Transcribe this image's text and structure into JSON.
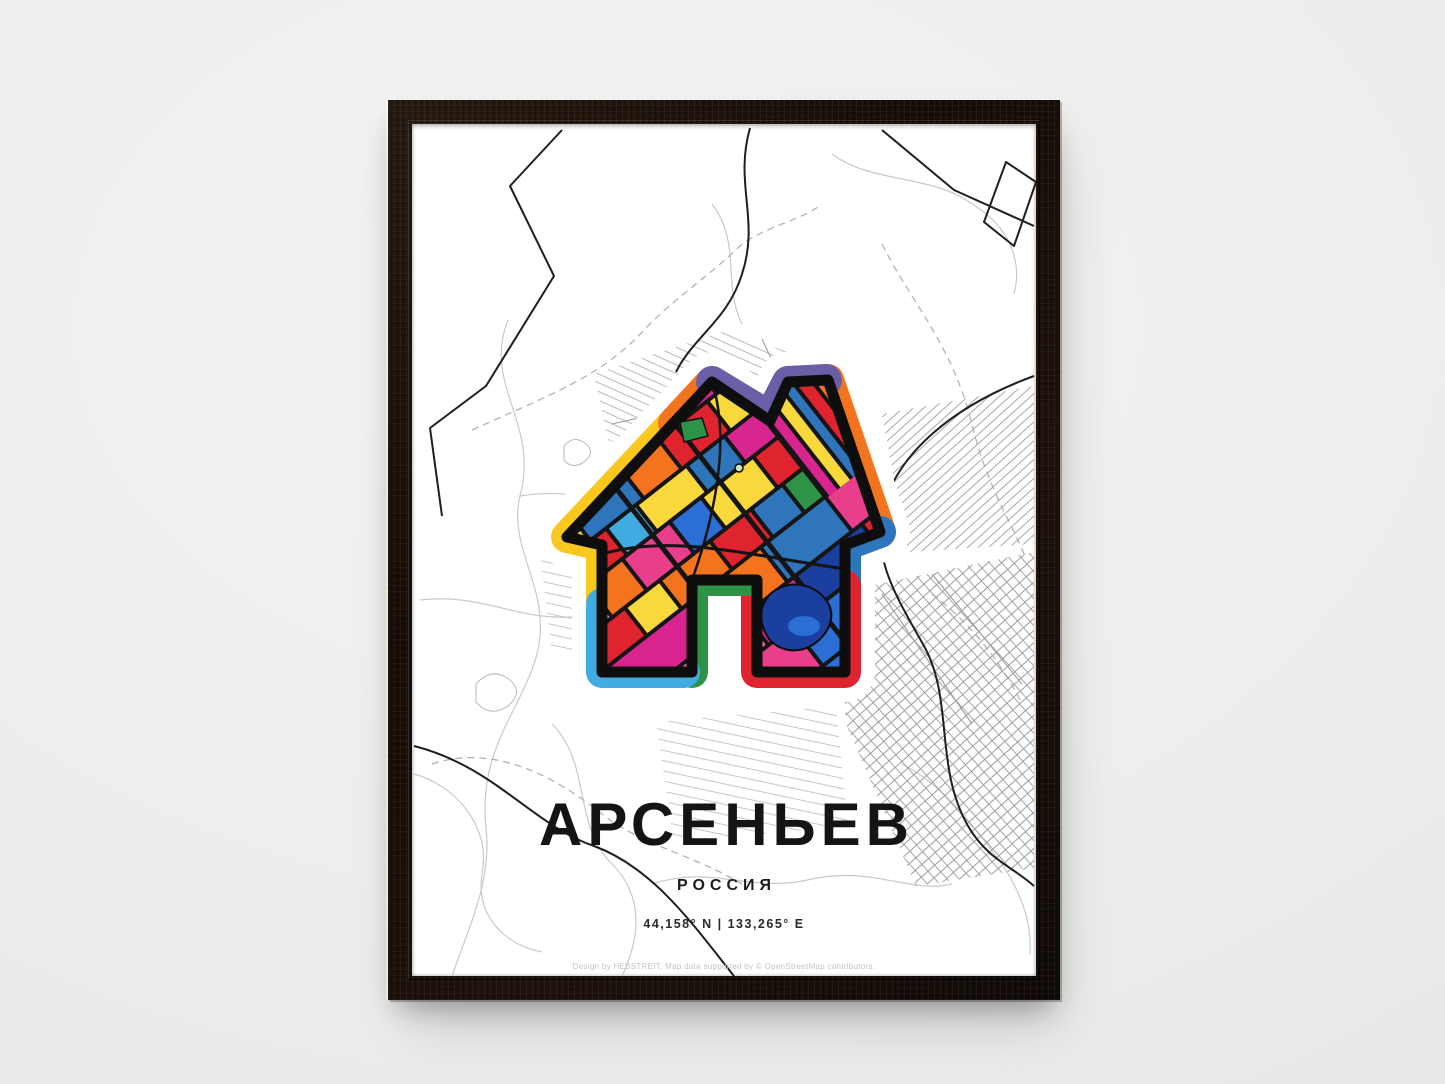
{
  "scene": {
    "wall_color": "#ebebe9",
    "frame_color": "#1a110a",
    "paper_color": "#ffffff"
  },
  "poster": {
    "title": "АРСЕНЬЕВ",
    "subtitle": "РОССИЯ",
    "coordinates": "44,158° N | 133,265° E",
    "credit": "Design by HEBSTREIT, Map data supported by © OpenStreetMap contributors.",
    "map_colors": {
      "minor_road": "#c9c9c9",
      "suburb_road": "#9c9c9c",
      "major_road": "#1f1f1f",
      "boundary": "#b3b3b3",
      "water_outline": "#bfbfbf"
    },
    "house_palette": {
      "yellow": "#F9C81E",
      "pale_yellow": "#F9D83C",
      "orange": "#F4731F",
      "red": "#E0242F",
      "blue": "#2E75BB",
      "royal": "#2B6FD4",
      "navy": "#1B3F9E",
      "cyan": "#41ACE1",
      "green": "#2E9247",
      "magenta": "#D9258F",
      "pink": "#E83E8C",
      "light_pink": "#F06AAE",
      "lavender": "#C9A7D8",
      "purple": "#6A5FA7",
      "outline": "#0E0E0E"
    }
  }
}
